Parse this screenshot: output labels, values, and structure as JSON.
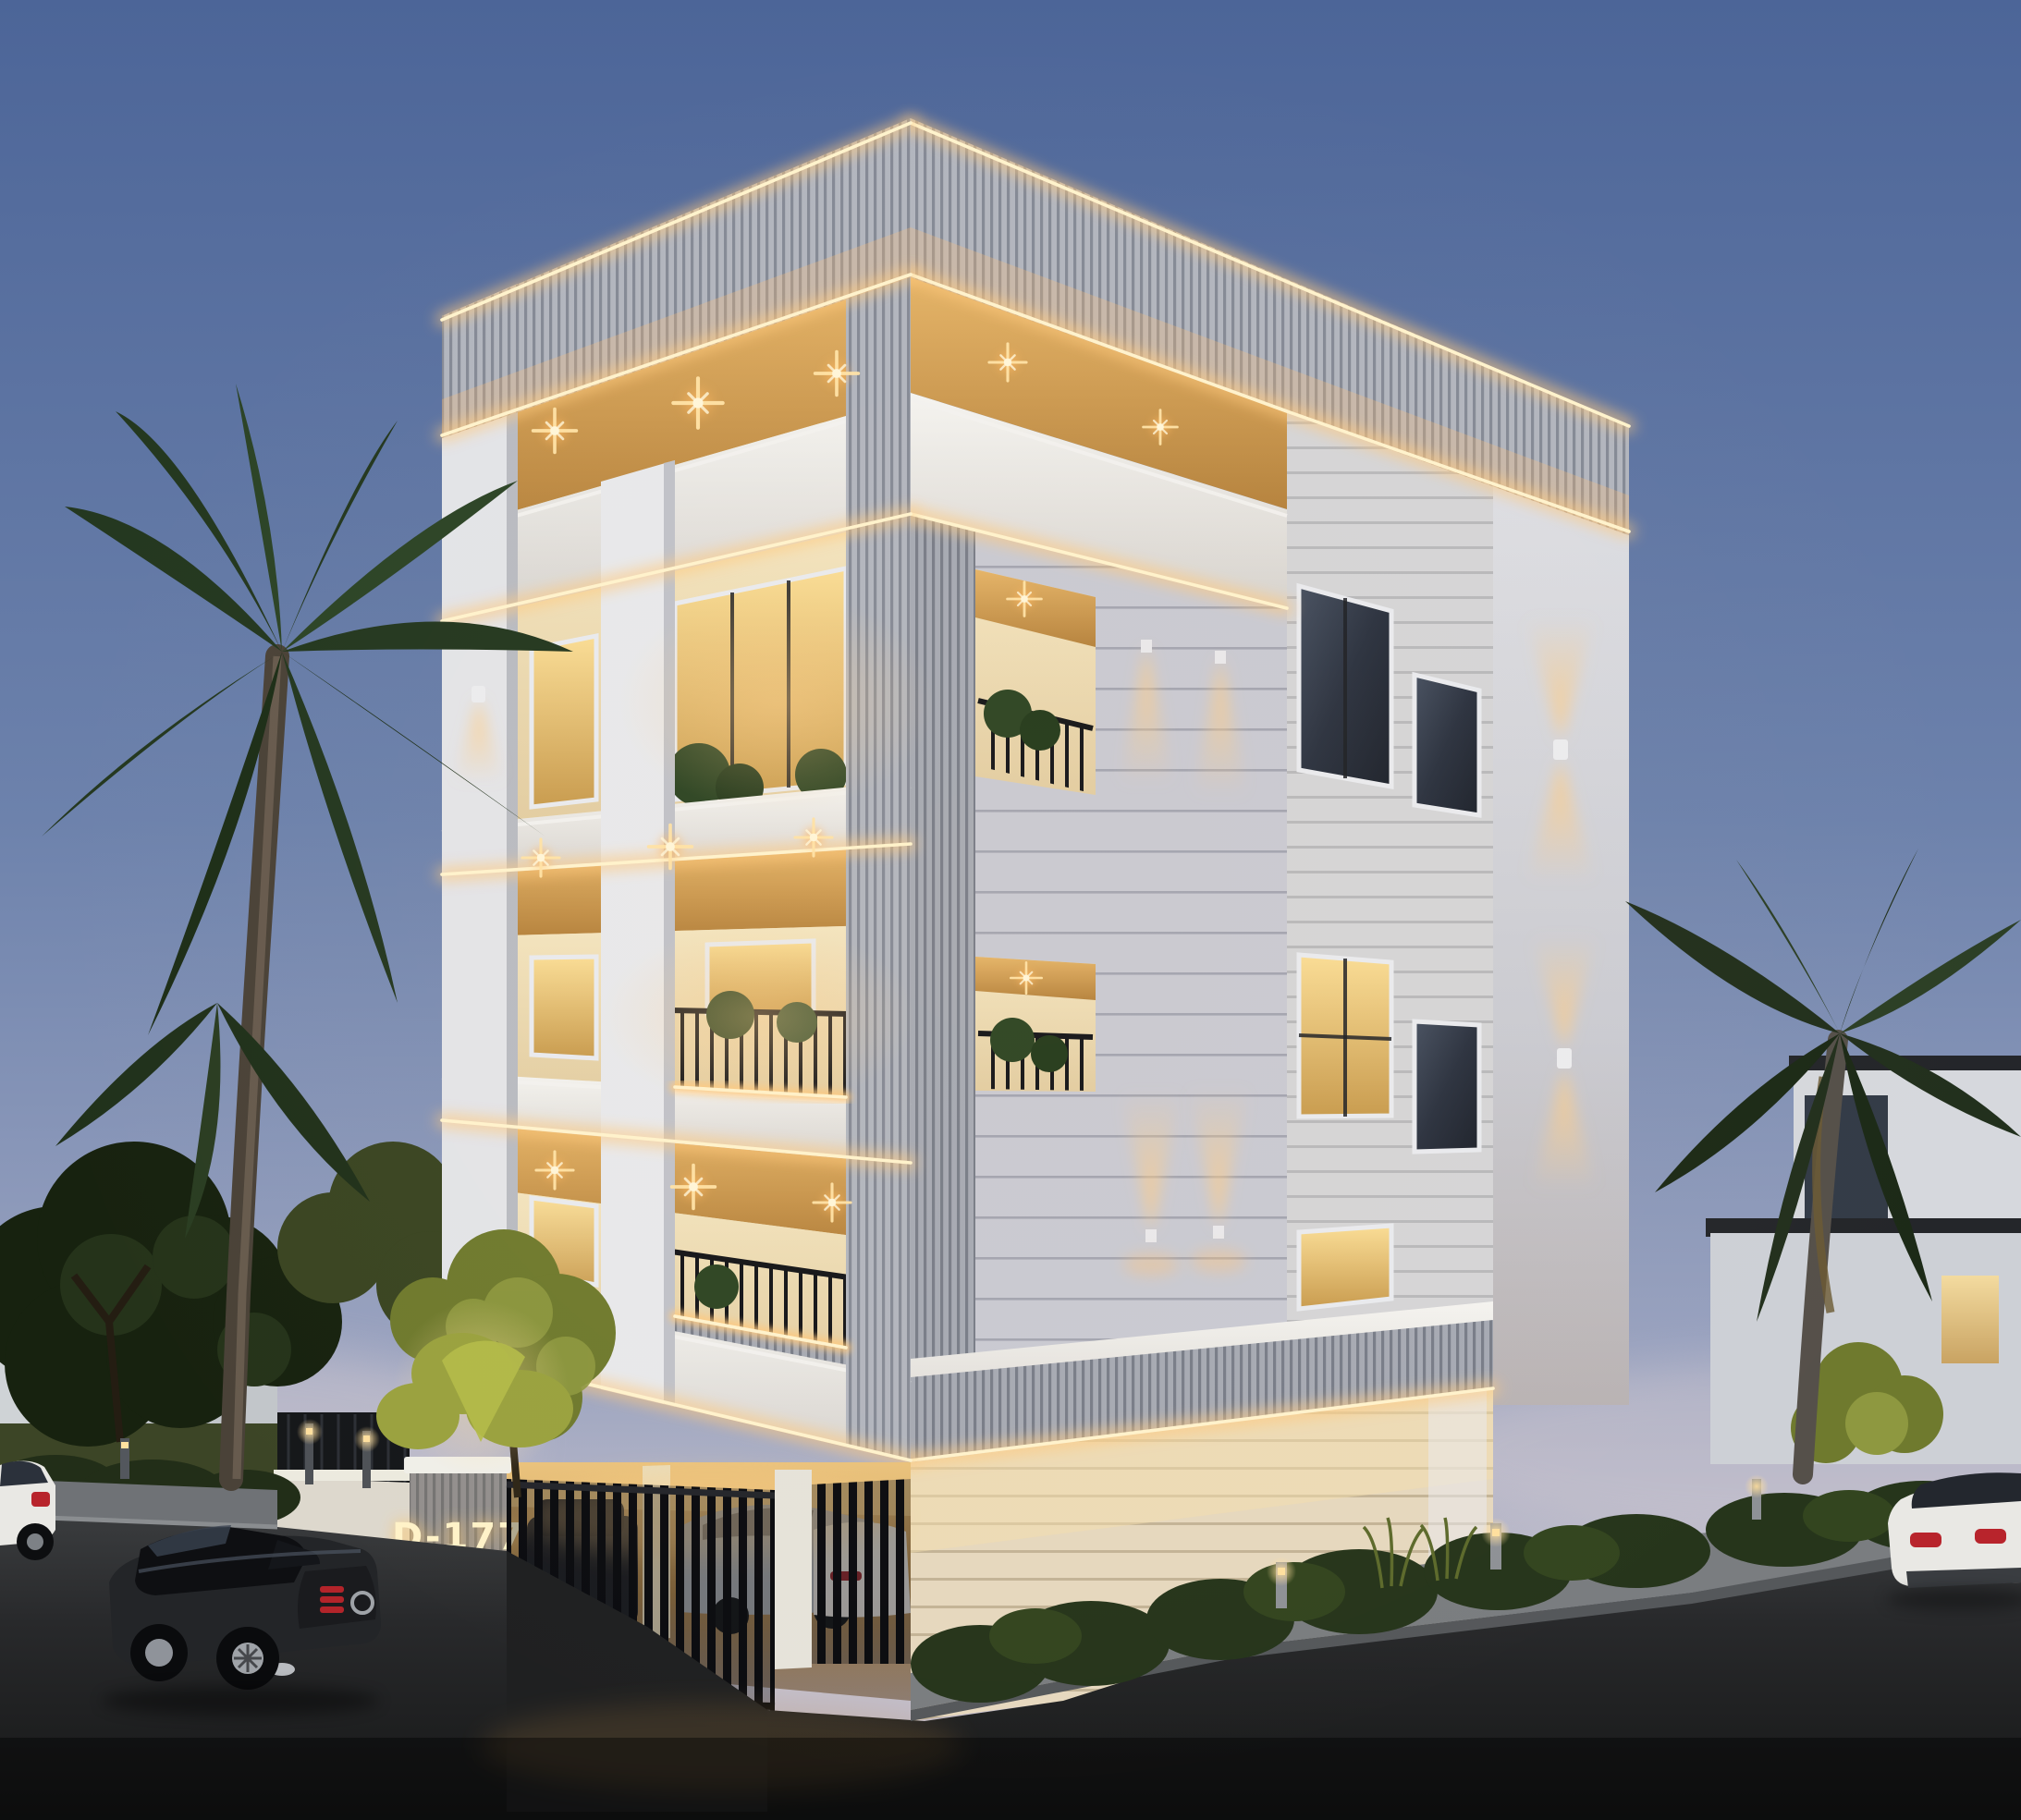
{
  "scene": {
    "type": "architectural exterior render",
    "time_of_day": "dusk",
    "subject": "modern neoclassical apartment building on a street corner",
    "floors_visible": 4,
    "ground_level": "stilt parking behind black slat gates",
    "street_vehicles": 3,
    "garage_vehicles": 3
  },
  "address_sign": {
    "text": "D-177"
  },
  "palette": {
    "sky_top": "#4c6598",
    "sky_mid": "#7287b1",
    "sky_horizon": "#c9c4ce",
    "facade_cream": "#efe0bd",
    "panel_flute_gray": "#b0b4bd",
    "trim_white": "#eceff2",
    "wood_soffit": "#dcab63",
    "stone_gray": "#c9cad3",
    "siding_gray": "#d2d4db",
    "led_core": "#fff3cd",
    "led_glow": "#ffc97e",
    "warm_light": "#ffbf6f",
    "railing_iron": "#141519",
    "foliage_dark": "#1b2614",
    "foliage_lit": "#8e9840",
    "palm_green": "#2a3d22",
    "asphalt": "#232425",
    "car_black": "#232528",
    "car_white": "#e9e8e4",
    "taillight_red": "#c22830"
  },
  "labels": {
    "building": "main-building",
    "garage": "stilt-parking-garage",
    "gate": "driveway-slat-gate",
    "sign": "address-sign",
    "left_palm": "palm-tree-left",
    "right_palm": "palm-tree-right",
    "road": "asphalt-road"
  }
}
